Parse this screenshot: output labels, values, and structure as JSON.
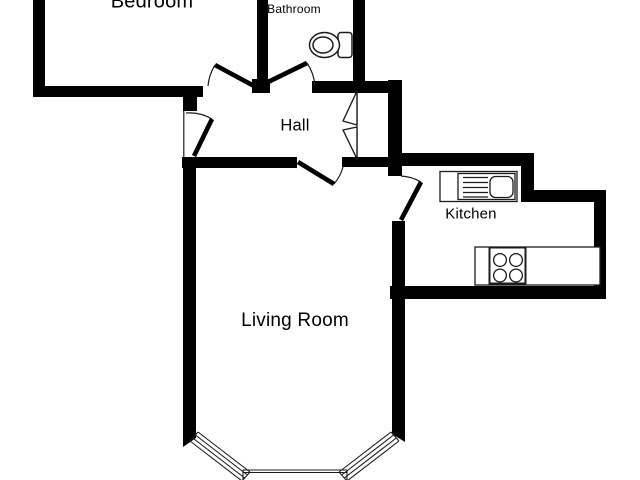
{
  "floorplan": {
    "title": "Flat floor plan",
    "rooms": [
      {
        "id": "bedroom",
        "label": "Bedroom"
      },
      {
        "id": "bathroom",
        "label": "Bathroom"
      },
      {
        "id": "hall",
        "label": "Hall"
      },
      {
        "id": "kitchen",
        "label": "Kitchen"
      },
      {
        "id": "living-room",
        "label": "Living Room"
      }
    ],
    "fixtures": [
      {
        "id": "toilet-icon",
        "room": "bathroom",
        "desc": "toilet with cistern"
      },
      {
        "id": "sink-icon",
        "room": "kitchen",
        "desc": "sink with drainer on counter"
      },
      {
        "id": "hob-icon",
        "room": "kitchen",
        "desc": "4-ring hob on counter"
      },
      {
        "id": "bay-window",
        "room": "living-room",
        "desc": "three-section bay window"
      },
      {
        "id": "folding-door",
        "room": "hall",
        "desc": "bi-fold closet door"
      },
      {
        "id": "entrance-door",
        "room": "hall",
        "desc": "entrance door swinging into hall"
      }
    ],
    "doors": [
      "bedroom-door",
      "bathroom-door",
      "entrance-door",
      "living-room-door",
      "kitchen-door",
      "folding-closet-door"
    ],
    "colors": {
      "wall": "#000000",
      "background": "#ffffff",
      "line": "#1c1c1c",
      "text": "#000000"
    }
  }
}
